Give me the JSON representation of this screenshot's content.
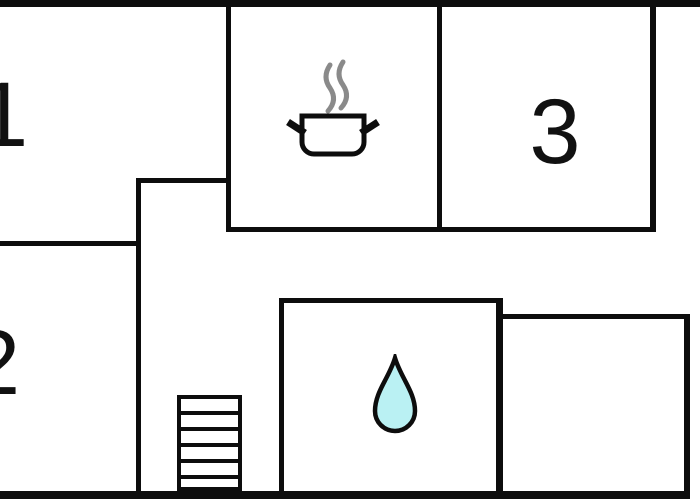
{
  "colors": {
    "wall": "#0d0d0d",
    "background": "#ffffff",
    "steam": "#8a8a8a",
    "water": "#baf1f3",
    "label": "#111111"
  },
  "rooms": {
    "room1": {
      "label": "1"
    },
    "room2": {
      "label": "2"
    },
    "room3": {
      "label": "3"
    },
    "kitchen": {
      "icon": "cooking-pot-icon"
    },
    "bathroom": {
      "icon": "water-drop-icon"
    }
  },
  "walls": [
    {
      "name": "wall-top",
      "x": 0,
      "y": 0,
      "w": 700,
      "h": 7
    },
    {
      "name": "wall-bottom",
      "x": 0,
      "y": 491,
      "w": 690,
      "h": 8
    },
    {
      "name": "wall-room1-right",
      "x": 226,
      "y": 7,
      "w": 5,
      "h": 225
    },
    {
      "name": "wall-step",
      "x": 137,
      "y": 178,
      "w": 94,
      "h": 5
    },
    {
      "name": "wall-center-vertical",
      "x": 136,
      "y": 178,
      "w": 5,
      "h": 313
    },
    {
      "name": "wall-room1-room2-divider",
      "x": 0,
      "y": 241,
      "w": 141,
      "h": 5
    },
    {
      "name": "wall-kitchen-bottom",
      "x": 226,
      "y": 227,
      "w": 430,
      "h": 5
    },
    {
      "name": "wall-kitchen-room3-divider",
      "x": 437,
      "y": 7,
      "w": 5,
      "h": 225
    },
    {
      "name": "wall-room3-right",
      "x": 650,
      "y": 7,
      "w": 6,
      "h": 225
    },
    {
      "name": "wall-bathroom-top",
      "x": 279,
      "y": 298,
      "w": 224,
      "h": 5
    },
    {
      "name": "wall-bathroom-left",
      "x": 279,
      "y": 298,
      "w": 5,
      "h": 193
    },
    {
      "name": "wall-bathroom-right",
      "x": 496,
      "y": 298,
      "w": 7,
      "h": 193
    },
    {
      "name": "wall-right-room-top",
      "x": 496,
      "y": 314,
      "w": 194,
      "h": 5
    },
    {
      "name": "wall-right-room-right",
      "x": 684,
      "y": 314,
      "w": 6,
      "h": 177
    }
  ],
  "stairs": {
    "x": 177,
    "y": 395,
    "w": 65,
    "h": 96,
    "steps": 6
  }
}
